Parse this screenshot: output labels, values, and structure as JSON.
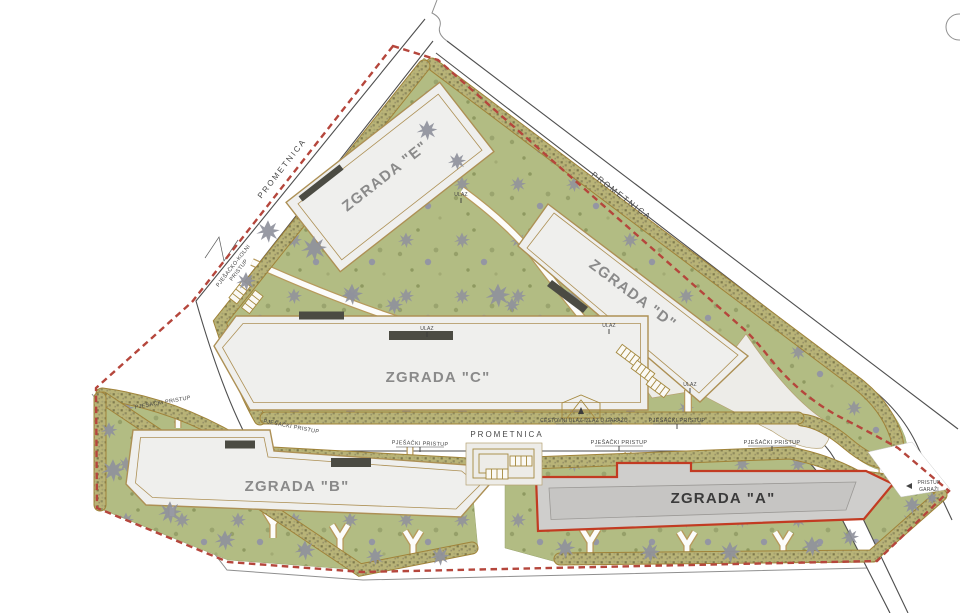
{
  "site": {
    "buildings": {
      "a": {
        "label": "ZGRADA \"A\""
      },
      "b": {
        "label": "ZGRADA \"B\""
      },
      "c": {
        "label": "ZGRADA \"C\""
      },
      "d": {
        "label": "ZGRADA \"D\""
      },
      "e": {
        "label": "ZGRADA \"E\""
      }
    },
    "roads": {
      "main_road": "PROMETNICA"
    },
    "access": {
      "pedestrian": "PJEŠAČKI PRISTUP",
      "pedestrian_vehicular_l1": "PJEŠAČKO-KOLNI",
      "pedestrian_vehicular_l2": "PRISTUP",
      "garage_entry_exit": "CESTOVNI ULAZ-IZLAZ U GARAŽU",
      "garage_access_l1": "PRISTUP",
      "garage_access_l2": "GARAŽI",
      "entrance": "ULAZ"
    },
    "colors": {
      "boundary_red": "#b5463c",
      "building_a_outline": "#c23b22",
      "building_a_fill": "#cfcecc",
      "building_fill": "#efefed",
      "outline_tan": "#ad9055",
      "greenery": "#b2bc83",
      "hedge": "#b8b377",
      "tree_gray": "#8f919c"
    }
  }
}
